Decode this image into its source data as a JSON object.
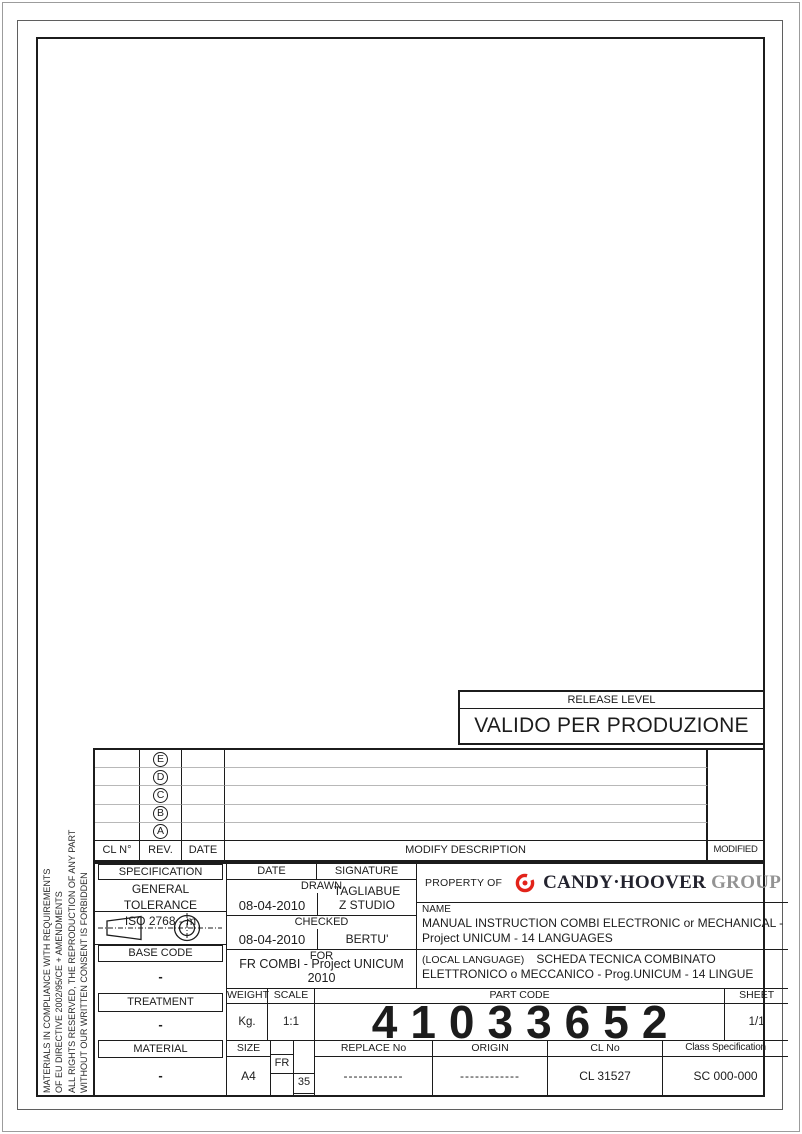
{
  "document": {
    "release": {
      "label": "RELEASE LEVEL",
      "value": "VALIDO PER PRODUZIONE"
    },
    "side_note": {
      "line1": "MATERIALS IN COMPLIANCE WITH REQUIREMENTS",
      "line2": "OF EU DIRECTIVE 2002/95/CE + AMENDMENTS",
      "line3": "ALL RIGHTS RESERVED, THE REPRODUCTION OF ANY PART",
      "line4": "WITHOUT OUR WRITTEN CONSENT IS FORBIDDEN"
    },
    "revisions": {
      "headers": {
        "cl_no": "CL N°",
        "rev": "REV.",
        "date": "DATE",
        "description": "MODIFY DESCRIPTION",
        "modified_by": "MODIFIED BY"
      },
      "rows": [
        {
          "rev": "E"
        },
        {
          "rev": "D"
        },
        {
          "rev": "C"
        },
        {
          "rev": "B"
        },
        {
          "rev": "A"
        }
      ]
    },
    "spec": {
      "header": "SPECIFICATION",
      "tolerance_label": "GENERAL TOLERANCE",
      "tolerance_value": "ISO 2768 - m",
      "projection_symbol": "first-angle-projection",
      "base_code_label": "BASE CODE",
      "base_code_value": "-",
      "treatment_label": "TREATMENT",
      "treatment_value": "-",
      "material_label": "MATERIAL",
      "material_value": "-"
    },
    "signoff": {
      "date_header": "DATE",
      "signature_header": "SIGNATURE",
      "drawn_label": "DRAWN",
      "drawn_date": "08-04-2010",
      "drawn_signature_line1": "TAGLIABUE",
      "drawn_signature_line2": "Z STUDIO",
      "checked_label": "CHECKED",
      "checked_date": "08-04-2010",
      "checked_signature": "BERTU'",
      "for_label": "FOR",
      "for_value": "FR COMBI - Project UNICUM 2010"
    },
    "property": {
      "label": "PROPERTY OF",
      "brand_main": "CANDY·HOOVER",
      "brand_suffix": "GROUP"
    },
    "name": {
      "label": "NAME",
      "line1": "MANUAL INSTRUCTION COMBI ELECTRONIC or MECHANICAL -",
      "line2": "Project UNICUM - 14 LANGUAGES"
    },
    "local": {
      "label": "(LOCAL LANGUAGE)",
      "line1": "SCHEDA TECNICA COMBINATO",
      "line2": "ELETTRONICO o MECCANICO - Prog.UNICUM - 14 LINGUE"
    },
    "meta": {
      "weight_label": "WEIGHT",
      "weight_value": "Kg.",
      "scale_label": "SCALE",
      "scale_value": "1:1",
      "part_code_label": "PART CODE",
      "part_code_value": "41033652",
      "sheet_label": "SHEET",
      "sheet_value": "1/1",
      "size_label": "SIZE",
      "size_value": "A4",
      "fr_label": "FR",
      "fr_value": "35",
      "replace_label": "REPLACE No",
      "replace_value": "------------",
      "origin_label": "ORIGIN",
      "origin_value": "------------",
      "cl_label": "CL No",
      "cl_value": "CL 31527",
      "class_label": "Class Specification",
      "class_value": "SC 000-000"
    },
    "colors": {
      "logo_red": "#e2231a",
      "brand_dark": "#23232e",
      "brand_gray": "#939393",
      "divider_gray": "#b8b8b8"
    }
  }
}
